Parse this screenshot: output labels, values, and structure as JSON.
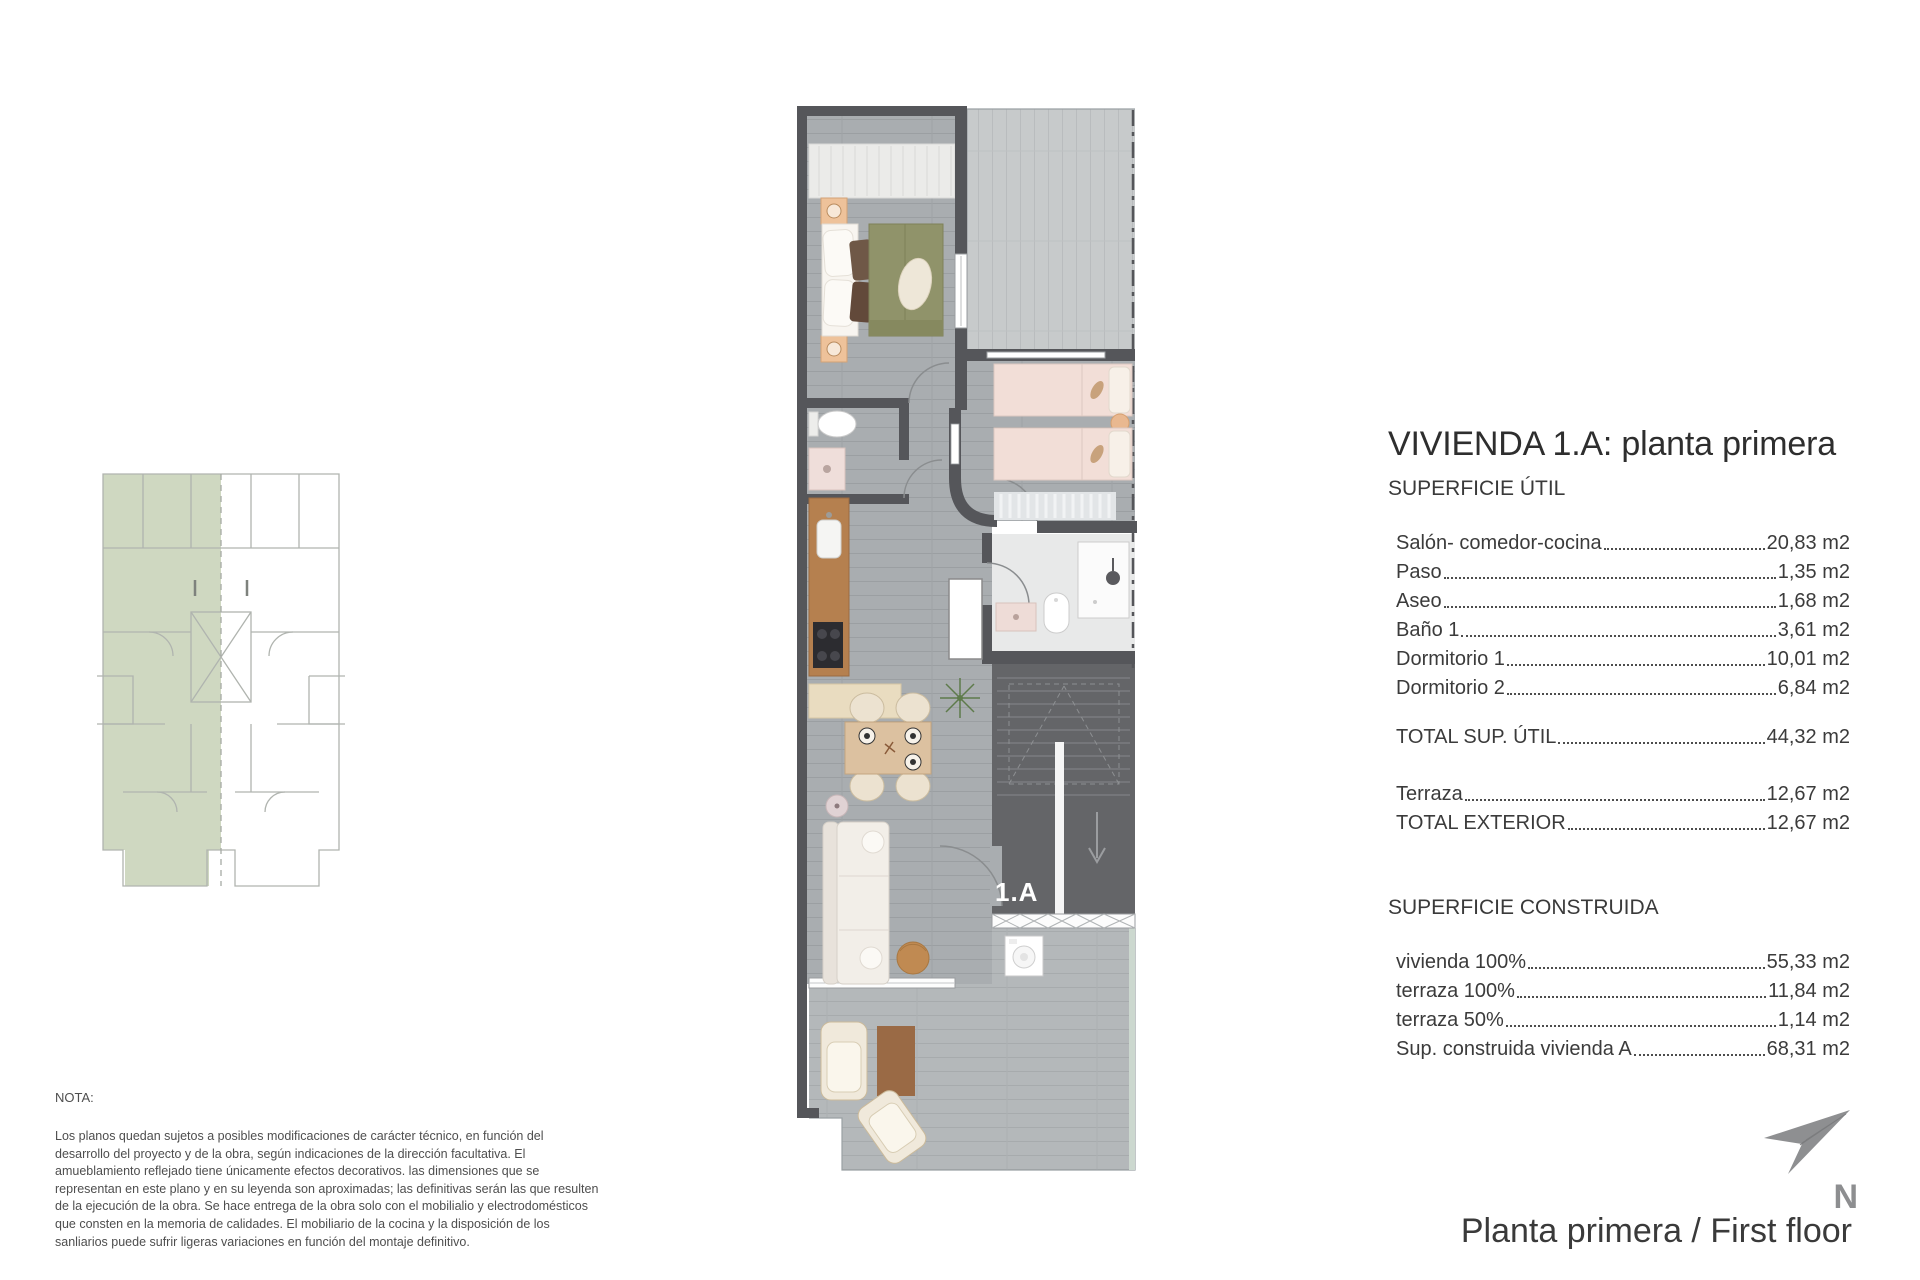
{
  "document": {
    "panel": {
      "title": "VIVIENDA 1.A: planta primera",
      "superficie_util": {
        "heading": "SUPERFICIE ÚTIL",
        "rows": [
          {
            "label": "Salón- comedor-cocina",
            "value": "20,83 m2"
          },
          {
            "label": "Paso",
            "value": "1,35 m2"
          },
          {
            "label": "Aseo",
            "value": "1,68 m2"
          },
          {
            "label": "Baño 1",
            "value": "3,61 m2"
          },
          {
            "label": "Dormitorio 1",
            "value": "10,01 m2"
          },
          {
            "label": "Dormitorio 2",
            "value": "6,84 m2"
          }
        ],
        "total_row": {
          "label": "TOTAL SUP. ÚTIL",
          "value": "44,32 m2"
        },
        "exterior_rows": [
          {
            "label": "Terraza",
            "value": "12,67 m2"
          },
          {
            "label": "TOTAL EXTERIOR",
            "value": "12,67 m2"
          }
        ]
      },
      "superficie_construida": {
        "heading": "SUPERFICIE CONSTRUIDA",
        "rows": [
          {
            "label": "vivienda 100%",
            "value": "55,33 m2"
          },
          {
            "label": "terraza 100%",
            "value": "11,84 m2"
          },
          {
            "label": "terraza 50%",
            "value": "1,14 m2"
          },
          {
            "label": "Sup. construida vivienda A",
            "value": "68,31 m2"
          }
        ]
      }
    },
    "nota": {
      "heading": "NOTA:",
      "body": "Los planos quedan sujetos a posibles modificaciones de carácter técnico, en función del desarrollo del proyecto y de la obra, según indicaciones de la dirección facultativa. El amueblamiento reflejado tiene únicamente efectos decorativos. las dimensiones que se representan en este plano y en su leyenda son aproximadas; las definitivas serán las que resulten de la ejecución de la obra. Se hace entrega de la obra solo con el mobilialio y electrodomésticos que consten en la memoria de calidades. El mobiliario de la cocina y la disposición de los sanliarios puede sufrir ligeras variaciones en función del montaje definitivo."
    },
    "footer": {
      "title": "Planta primera / First floor",
      "north_label": "N"
    },
    "plan": {
      "unit_label": "1.A"
    },
    "colors": {
      "wall": "#55565a",
      "interior_floor": "#a9adb0",
      "terrace_floor_light": "#c7cacb",
      "terrace_floor_gray": "#b7babc",
      "site_plan_highlight": "#cfd8c1",
      "north_arrow": "#8e8f91",
      "bed_duvet_olive": "#90936a",
      "bed_pink": "#f2ded7",
      "kitchen_wood": "#b5804f"
    }
  }
}
